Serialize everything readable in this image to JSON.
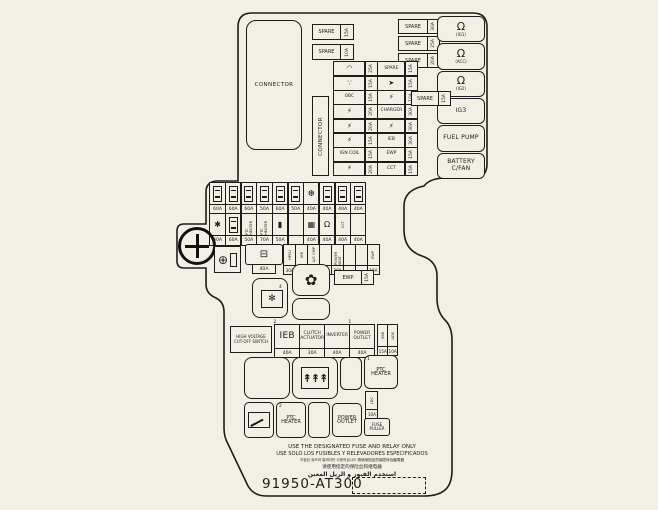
{
  "colors": {
    "background": "#f2efe4",
    "line": "#1c1c1c"
  },
  "top": {
    "connector_label": "CONNECTOR",
    "connector_vertical_label": "CONNECTOR",
    "spare_left": [
      {
        "label": "SPARE",
        "rating": "15A"
      },
      {
        "label": "SPARE",
        "rating": "10A"
      }
    ],
    "spare_right": [
      {
        "label": "SPARE",
        "rating": "30A"
      },
      {
        "label": "SPARE",
        "rating": "25A"
      },
      {
        "label": "SPARE",
        "rating": "20A"
      }
    ],
    "spare_mid": {
      "label": "SPARE",
      "rating": "15A"
    },
    "relays": [
      {
        "glyph": "Ω",
        "icon": "relay-coil-icon",
        "label": "(IG1)"
      },
      {
        "glyph": "Ω",
        "icon": "relay-coil-icon",
        "label": "(ACC)"
      },
      {
        "glyph": "Ω",
        "icon": "relay-coil-icon",
        "label": "(IG2)"
      },
      {
        "label": "IG3"
      },
      {
        "label": "FUEL PUMP"
      },
      {
        "label": "BATTERY C/FAN"
      }
    ],
    "fuse_rows": [
      {
        "g1": "◠",
        "i1": "wiper-icon",
        "r1": "25A",
        "l2": "SPARE",
        "r2": "15A"
      },
      {
        "g1": "∵",
        "i1": "washer-icon",
        "r1": "15A",
        "g2": "➤",
        "i2": "horn-icon",
        "r2": "15A"
      },
      {
        "l1": "OBC",
        "r1": "15A",
        "g2": "⚡",
        "i2": "charger-plug-icon",
        "r2": "10A"
      },
      {
        "g1": "⚡",
        "i1": "charger-plug-icon",
        "r1": "20A",
        "l2": "CHARGER",
        "r2": "30A"
      },
      {
        "g1": "⚡",
        "i1": "charger-plug-icon",
        "r1": "20A",
        "g2": "⚡",
        "i2": "charger-plug-icon",
        "r2": "30A"
      },
      {
        "g1": "⚡",
        "i1": "charger-plug-icon",
        "r1": "15A",
        "l2": "IEB",
        "r2": "30A"
      },
      {
        "l1": "IGN COIL",
        "r1": "15A",
        "l2": "EWP",
        "r2": "15A"
      },
      {
        "g1": "⚡",
        "i1": "charger-plug-icon",
        "r1": "20A",
        "l2": "CCT",
        "r2": "15A"
      }
    ]
  },
  "midifuse": {
    "row_a": [
      {
        "sym": true,
        "rating": "60A"
      },
      {
        "sym": true,
        "rating": "60A"
      },
      {
        "sym": true,
        "rating": "60A"
      },
      {
        "sym": true,
        "rating": "50A"
      },
      {
        "sym": true,
        "rating": "60A"
      },
      {
        "sym": true,
        "rating": "50A"
      },
      {
        "glyph": "❆",
        "icon": "snowflake-icon",
        "rating": "40A"
      },
      {
        "sym": true,
        "rating": "40A"
      },
      {
        "sym": true,
        "rating": "40A"
      },
      {
        "sym": true,
        "rating": "40A"
      }
    ],
    "row_b": [
      {
        "glyph": "✱",
        "icon": "star-icon",
        "rating": "60A"
      },
      {
        "sym": true,
        "rating": "60A"
      },
      {
        "vlabel": "PTC HEATER",
        "rating": "50A"
      },
      {
        "vlabel": "PTC HEATER",
        "rating": "70A"
      },
      {
        "glyph": "▮",
        "icon": "plug-icon",
        "rating": "50A"
      },
      {
        "rating": ""
      },
      {
        "glyph": "▦",
        "icon": "grid-icon",
        "rating": "40A"
      },
      {
        "glyph": "Ω",
        "icon": "relay-coil-icon",
        "rating": "40A"
      },
      {
        "vlabel": "CCT",
        "rating": "40A"
      },
      {
        "rating": "40A"
      }
    ],
    "row_c_battery": {
      "glyph": "⊟",
      "icon": "battery-icon",
      "rating": "40A"
    },
    "row_c_fuses": [
      {
        "vlabel": "HPCU",
        "rating": "30A"
      },
      {
        "vlabel": "IEB",
        "rating": "20A"
      },
      {
        "vlabel": "A/C CMP",
        "rating": "20A"
      },
      {
        "vlabel": "",
        "rating": ""
      },
      {
        "vlabel": "POWER SEAT",
        "rating": "30A"
      },
      {
        "vlabel": "",
        "rating": ""
      },
      {
        "vlabel": "",
        "rating": ""
      },
      {
        "vlabel": "EWP",
        "rating": "10A"
      }
    ]
  },
  "mid": {
    "ewp_fuse": {
      "label": "EWP",
      "rating": "15A"
    },
    "fan_glyph": "✿",
    "ac_glyph": "✻",
    "ac_sup": "4"
  },
  "bottom": {
    "hv_line1": "HIGH VOLTAGE",
    "hv_line2": "CUT-OFF SWITCH",
    "row_d": [
      {
        "label": "IEB",
        "rating": "40A",
        "sup": "2"
      },
      {
        "label": "CLUTCH ACTUATOR",
        "rating": "30A"
      },
      {
        "label": "INVERTER",
        "rating": "40A"
      },
      {
        "label": "POWER OUTLET",
        "rating": "40A",
        "sup": "1"
      }
    ],
    "row_d_small": [
      {
        "vlabel": "SSB",
        "rating": "15A"
      },
      {
        "vlabel": "ADS",
        "rating": "10A"
      }
    ],
    "heater_glyph": "↟↟↟",
    "ptc1_label": "PTC HEATER",
    "ptc1_sup": "1",
    "ptc2_label": "PTC HEATER",
    "ptc2_sup": "2",
    "power_outlet_label": "POWER OUTLET",
    "ldc_fuse": {
      "vlabel": "LDC",
      "rating": "10A"
    },
    "fuse_puller_label": "FUSE PULLER"
  },
  "footer": {
    "line1": "USE THE DESIGNATED FUSE AND RELAY ONLY",
    "line2": "USE SOLO LOS FUSIBLES Y RELEVADORES ESPECIFICADOS",
    "line3": "지정된 퓨즈와 릴레이만 사용하십시오  請使用指定的保險絲及繼電器",
    "line4_cjk": "请使用指定的保险丝和继电器",
    "line4_ar": "استخدم الفيوز و الريل المعين",
    "part_number": "91950-AT300"
  }
}
